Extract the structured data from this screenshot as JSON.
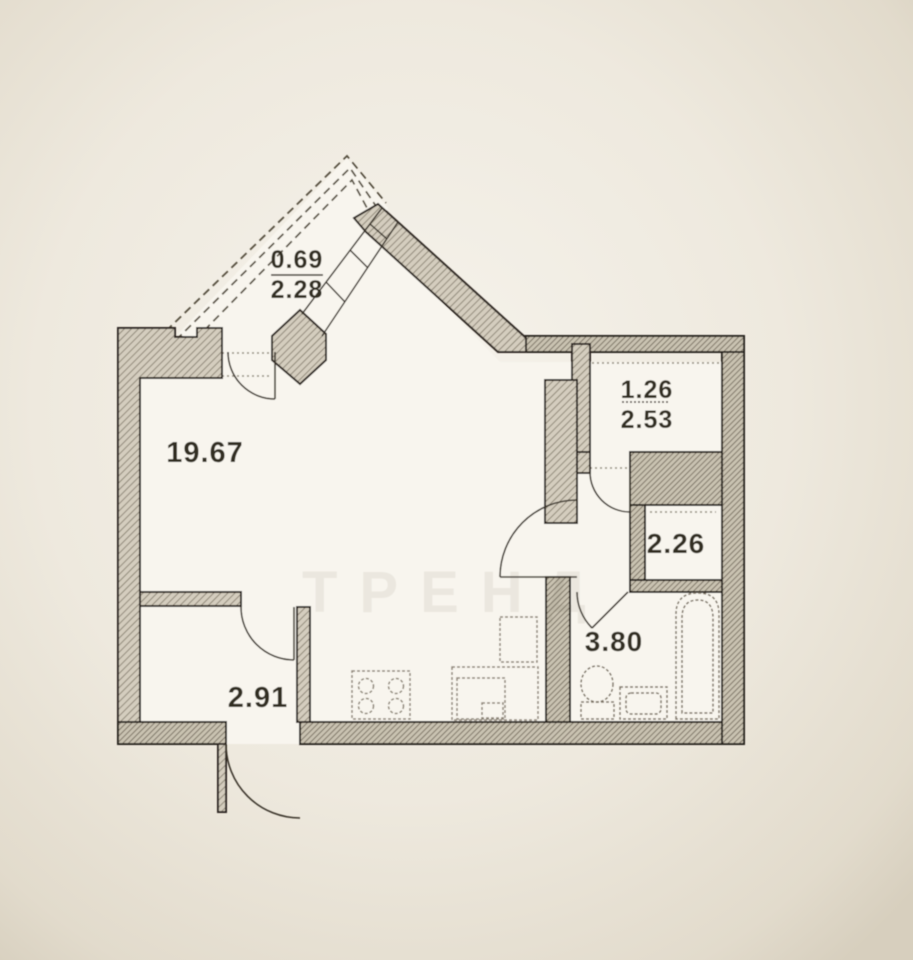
{
  "document": {
    "kind": "apartment floor plan (scanned photo)",
    "units": "square meters"
  },
  "colors": {
    "paper": "#efeae0",
    "floor": "#f8f5ee",
    "wall_fill": "#d2cbbc",
    "wall_hatch": "#797163",
    "outline": "#2e2821",
    "fixture_line": "#8c8476",
    "label_text": "#332d24"
  },
  "rooms": {
    "living": {
      "name": "living-room-kitchen",
      "area": "19.67"
    },
    "balcony": {
      "name": "triangular-balcony",
      "area_reduced": "0.69",
      "area_full": "2.28"
    },
    "corridor": {
      "name": "entry-corridor",
      "area_reduced": "1.26",
      "area_full": "2.53"
    },
    "closet": {
      "name": "built-in-closet",
      "area": "2.26"
    },
    "bathroom": {
      "name": "bathroom",
      "area": "3.80"
    },
    "hallway": {
      "name": "entrance-hall",
      "area": "2.91"
    }
  },
  "fixtures": {
    "kitchen": [
      "stove-4-burner",
      "counter-with-sink",
      "tall-cabinet"
    ],
    "bathroom": [
      "bathtub",
      "pedestal-sink",
      "washing-machine"
    ]
  },
  "doors": [
    "balcony-door",
    "hallway-door",
    "entrance-door",
    "living-room-door",
    "corridor-door",
    "bathroom-door"
  ],
  "watermark": "ТРЕНД"
}
